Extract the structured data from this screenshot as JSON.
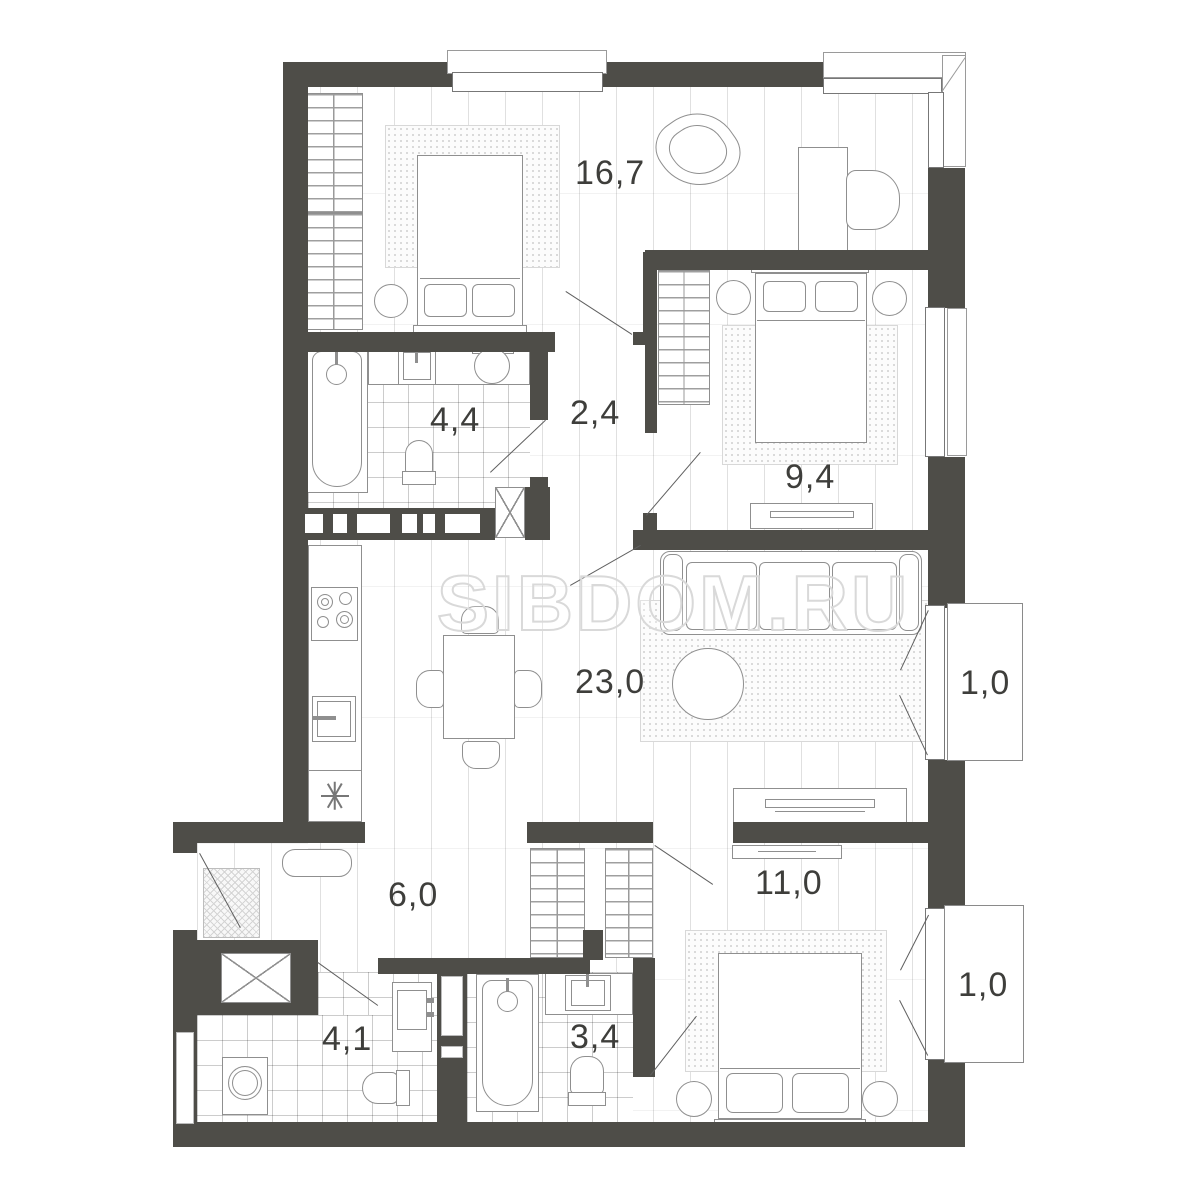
{
  "plan": {
    "watermark": "SIBDOM.RU",
    "rooms": [
      {
        "name": "bedroom-main",
        "area": "16,7"
      },
      {
        "name": "hall",
        "area": "2,4"
      },
      {
        "name": "bathroom-top",
        "area": "4,4"
      },
      {
        "name": "bedroom-right",
        "area": "9,4"
      },
      {
        "name": "living-kitchen",
        "area": "23,0"
      },
      {
        "name": "balcony-living",
        "area": "1,0"
      },
      {
        "name": "hallway-entry",
        "area": "6,0"
      },
      {
        "name": "bedroom-bottom",
        "area": "11,0"
      },
      {
        "name": "balcony-bedroom",
        "area": "1,0"
      },
      {
        "name": "bathroom-entry",
        "area": "4,1"
      },
      {
        "name": "bathroom-ensuite",
        "area": "3,4"
      }
    ],
    "colors": {
      "wall": "#4e4d48",
      "line": "#8f8f8f",
      "label": "#3e3e3b",
      "watermark_stroke": "#d9d9d9"
    }
  }
}
